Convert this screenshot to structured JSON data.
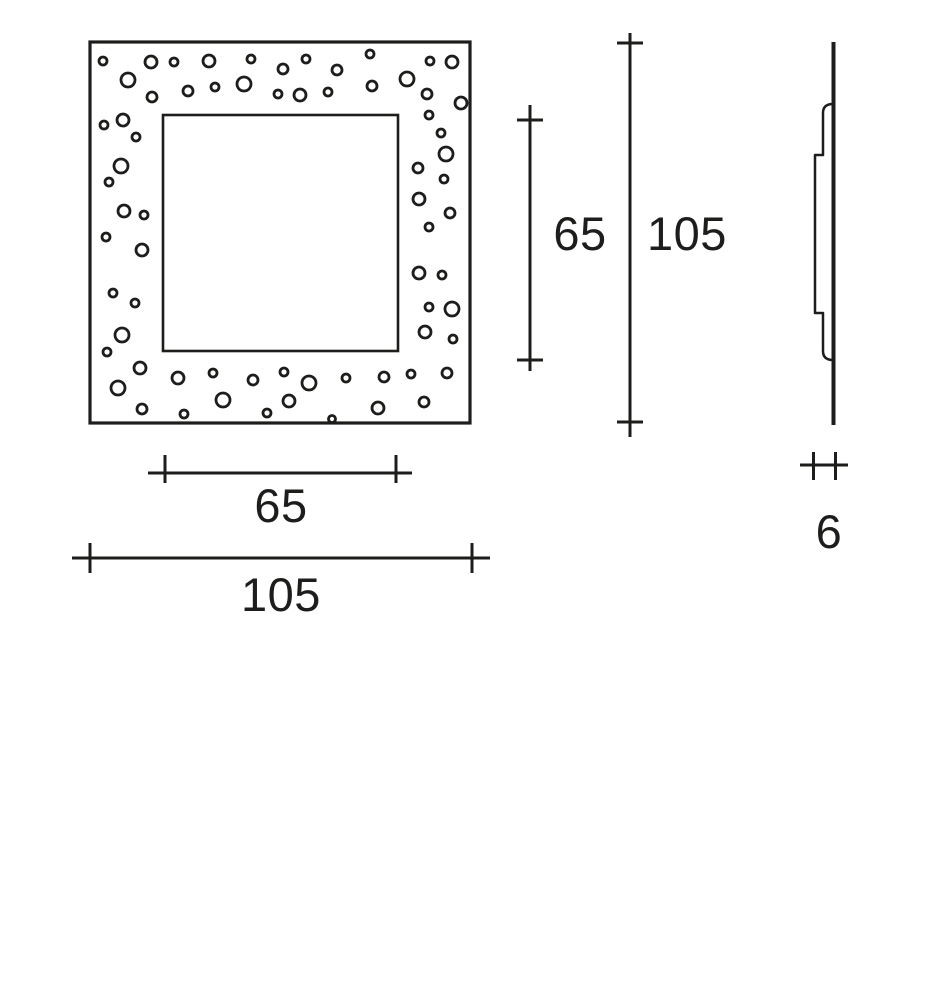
{
  "meta": {
    "drawing_type": "technical dimension drawing",
    "subject": "square cover plate with bubble perforation pattern, front view and side profile view",
    "units_shown": [
      "65",
      "105",
      "65",
      "105",
      "6"
    ]
  },
  "colors": {
    "ink": "#1d1d1b",
    "background": "#ffffff"
  },
  "front_view": {
    "outer_square": {
      "x": 90,
      "y": 42,
      "width": 380,
      "height": 381
    },
    "inner_square": {
      "x": 163,
      "y": 115,
      "width": 235,
      "height": 236
    },
    "dots": [
      [
        103,
        61,
        4
      ],
      [
        128,
        80,
        7
      ],
      [
        151,
        62,
        6
      ],
      [
        152,
        97,
        5
      ],
      [
        174,
        62,
        4
      ],
      [
        188,
        91,
        5
      ],
      [
        209,
        61,
        6
      ],
      [
        215,
        87,
        4
      ],
      [
        244,
        84,
        7
      ],
      [
        251,
        59,
        4
      ],
      [
        278,
        94,
        4
      ],
      [
        283,
        69,
        5
      ],
      [
        300,
        95,
        6
      ],
      [
        306,
        59,
        4
      ],
      [
        328,
        92,
        4
      ],
      [
        337,
        70,
        5
      ],
      [
        370,
        54,
        4
      ],
      [
        372,
        86,
        5
      ],
      [
        407,
        79,
        7
      ],
      [
        430,
        61,
        4
      ],
      [
        427,
        94,
        5
      ],
      [
        452,
        62,
        6
      ],
      [
        461,
        103,
        6
      ],
      [
        104,
        125,
        4
      ],
      [
        123,
        120,
        6
      ],
      [
        136,
        137,
        4
      ],
      [
        121,
        166,
        7
      ],
      [
        109,
        182,
        4
      ],
      [
        124,
        211,
        6
      ],
      [
        144,
        215,
        4
      ],
      [
        106,
        237,
        4
      ],
      [
        142,
        250,
        6
      ],
      [
        113,
        293,
        4
      ],
      [
        135,
        303,
        4
      ],
      [
        122,
        335,
        7
      ],
      [
        107,
        352,
        4
      ],
      [
        140,
        368,
        6
      ],
      [
        118,
        388,
        7
      ],
      [
        142,
        409,
        5
      ],
      [
        178,
        378,
        6
      ],
      [
        184,
        414,
        4
      ],
      [
        213,
        373,
        4
      ],
      [
        223,
        400,
        7
      ],
      [
        253,
        380,
        5
      ],
      [
        267,
        413,
        4
      ],
      [
        284,
        372,
        4
      ],
      [
        289,
        401,
        6
      ],
      [
        309,
        383,
        7
      ],
      [
        332,
        419,
        3.5
      ],
      [
        346,
        378,
        4
      ],
      [
        384,
        377,
        5
      ],
      [
        378,
        408,
        6
      ],
      [
        411,
        374,
        4
      ],
      [
        424,
        402,
        5
      ],
      [
        447,
        373,
        5
      ],
      [
        429,
        115,
        4
      ],
      [
        441,
        133,
        4
      ],
      [
        446,
        154,
        7
      ],
      [
        418,
        168,
        5
      ],
      [
        444,
        179,
        4
      ],
      [
        419,
        199,
        6
      ],
      [
        450,
        213,
        5
      ],
      [
        429,
        227,
        4
      ],
      [
        419,
        273,
        6
      ],
      [
        442,
        275,
        4
      ],
      [
        429,
        307,
        4
      ],
      [
        452,
        309,
        7
      ],
      [
        425,
        332,
        6
      ],
      [
        453,
        339,
        4
      ]
    ]
  },
  "side_view": {
    "plate_edge": {
      "x": 833.5,
      "y1": 42,
      "y2": 425
    },
    "profile_path": "M 832 104 Q 823 104.5 823 113 L 823 155 L 815 155 L 815 313 L 823 313 L 823 351 Q 823 359.5 832 360"
  },
  "dimensions": [
    {
      "id": "window-width",
      "value": "65",
      "orientation": "horizontal",
      "line": {
        "x1": 148,
        "x2": 412,
        "y": 473
      },
      "ticks": {
        "positions": [
          165,
          396
        ],
        "from": 455,
        "to": 483
      },
      "label": {
        "x": 281,
        "y": 522
      }
    },
    {
      "id": "plate-width",
      "value": "105",
      "orientation": "horizontal",
      "line": {
        "x1": 72,
        "x2": 490,
        "y": 558
      },
      "ticks": {
        "positions": [
          90,
          472
        ],
        "from": 543,
        "to": 573
      },
      "label": {
        "x": 281,
        "y": 611
      }
    },
    {
      "id": "window-height",
      "value": "65",
      "orientation": "vertical",
      "line": {
        "y1": 105,
        "y2": 371,
        "x": 530
      },
      "ticks": {
        "positions": [
          120,
          360
        ],
        "from": 517,
        "to": 543
      },
      "label": {
        "x": 580,
        "y": 250
      }
    },
    {
      "id": "plate-height",
      "value": "105",
      "orientation": "vertical",
      "line": {
        "y1": 33,
        "y2": 437,
        "x": 630
      },
      "ticks": {
        "positions": [
          43,
          422
        ],
        "from": 617,
        "to": 643
      },
      "label": {
        "x": 687,
        "y": 250
      }
    },
    {
      "id": "plate-thickness",
      "value": "6",
      "orientation": "horizontal",
      "line": {
        "x1": 800,
        "x2": 848,
        "y": 465
      },
      "ticks": {
        "positions": [
          813.5,
          835.5
        ],
        "from": 452,
        "to": 480
      },
      "label": {
        "x": 829,
        "y": 548
      }
    }
  ]
}
